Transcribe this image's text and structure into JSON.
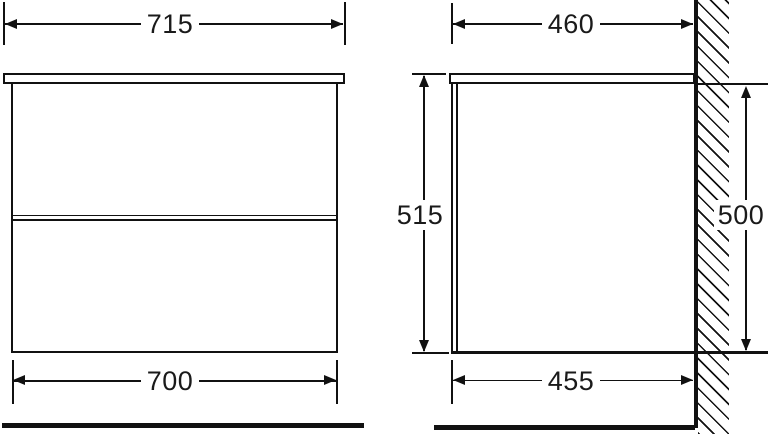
{
  "diagram": {
    "type": "technical-drawing",
    "subject": "wall-mounted vanity cabinet, front and side elevations with dimensions",
    "front_view": {
      "countertop_width": "715",
      "cabinet_width": "700"
    },
    "side_view": {
      "countertop_depth": "460",
      "cabinet_depth": "455",
      "overall_height": "515",
      "cabinet_height": "500"
    },
    "colors": {
      "line": "#111111",
      "background": "#ffffff"
    }
  }
}
